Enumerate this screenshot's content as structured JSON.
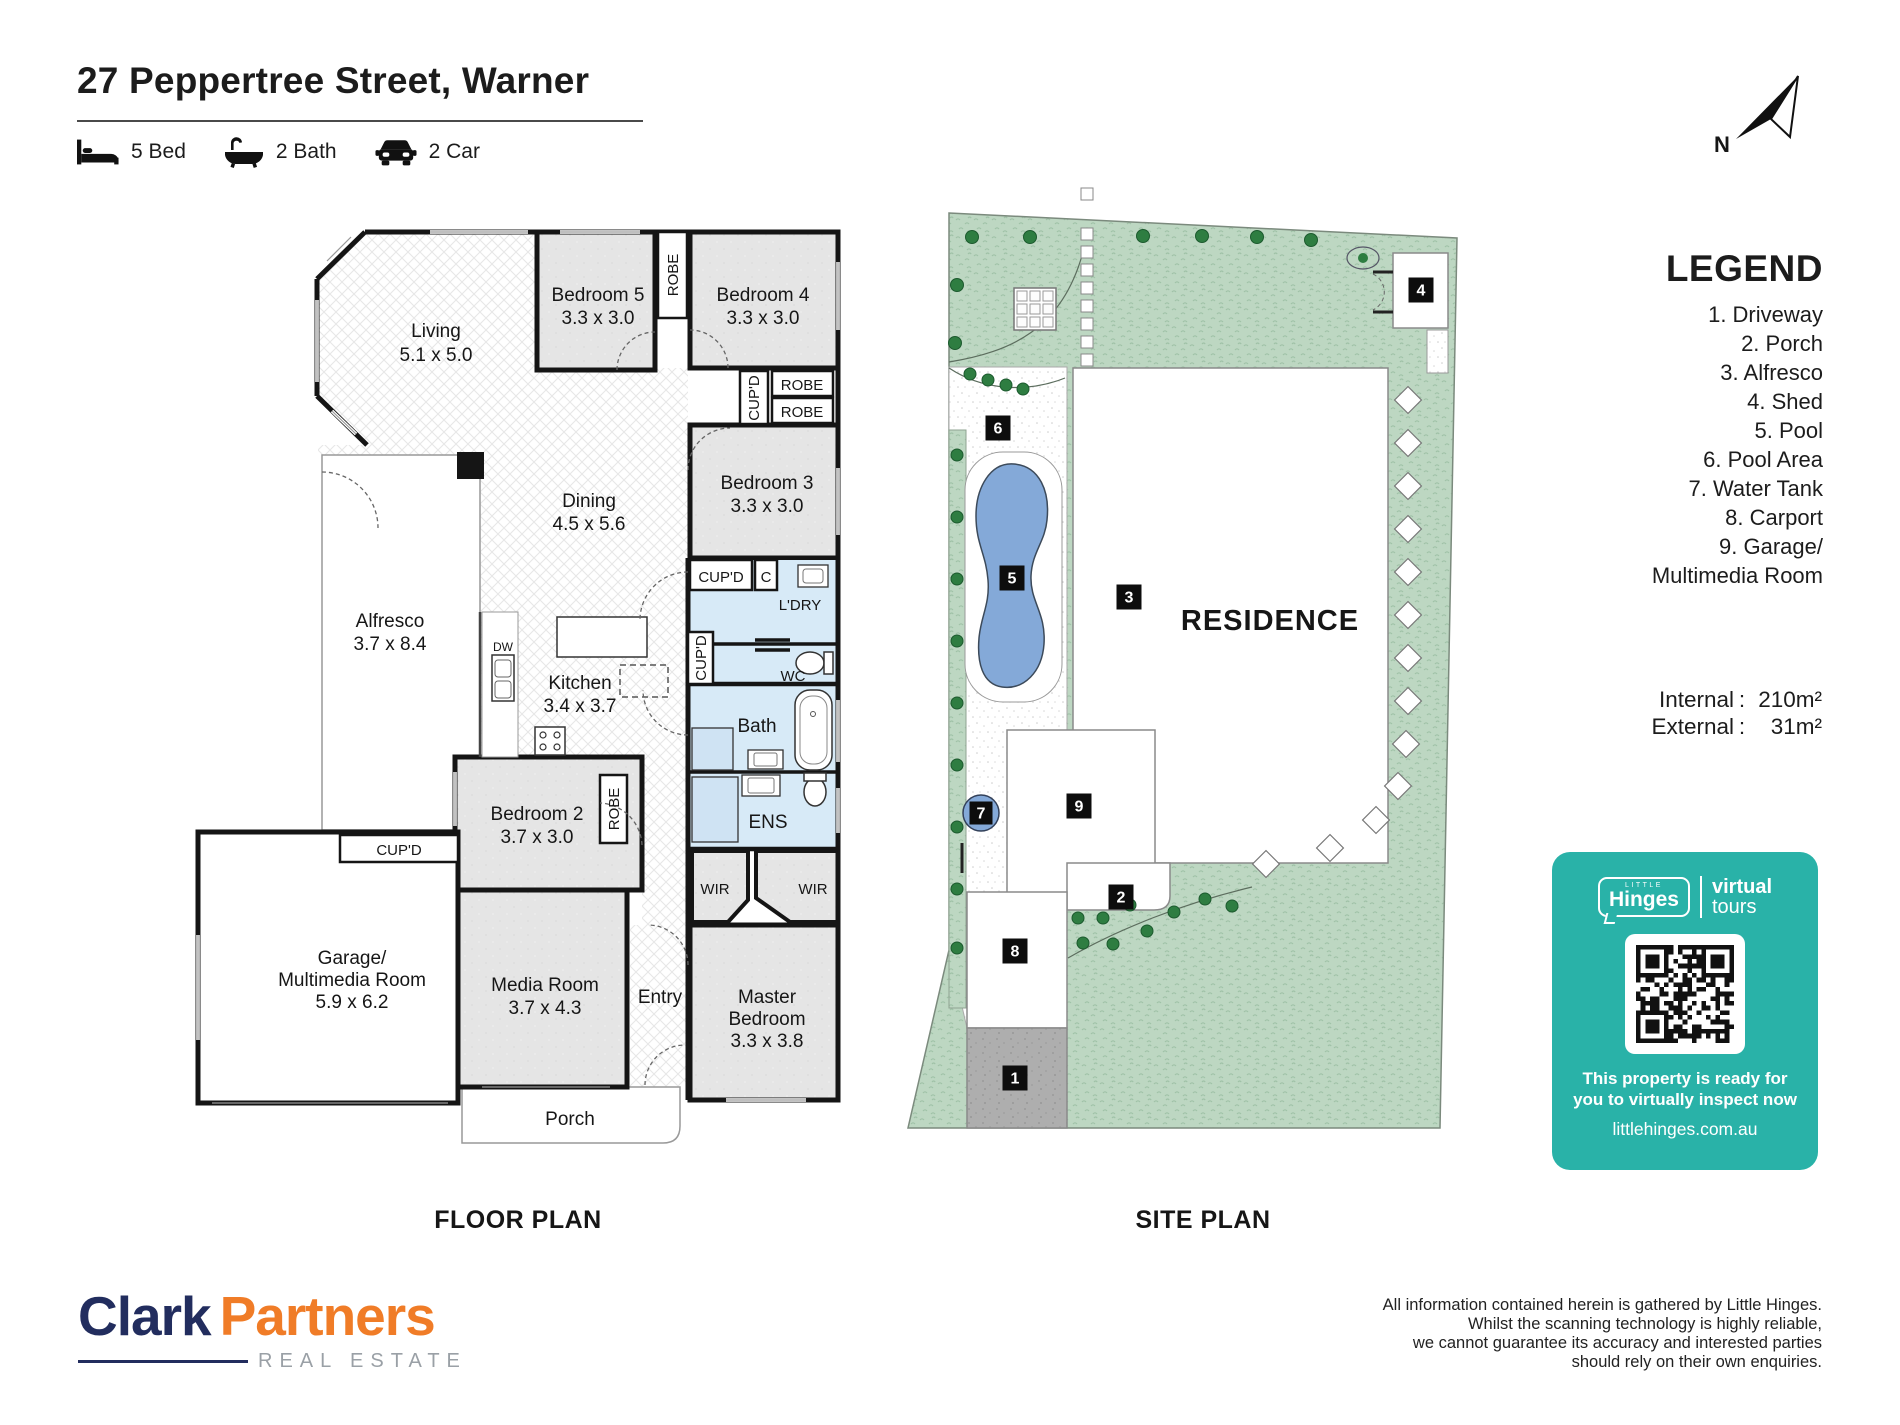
{
  "header": {
    "address": "27 Peppertree Street, Warner",
    "stats": [
      {
        "icon": "bed-icon",
        "label": "5 Bed"
      },
      {
        "icon": "bath-icon",
        "label": "2 Bath"
      },
      {
        "icon": "car-icon",
        "label": "2 Car"
      }
    ]
  },
  "north": {
    "label": "N"
  },
  "floor_plan": {
    "title": "FLOOR PLAN",
    "rooms": {
      "living": {
        "name": "Living",
        "dims": "5.1 x 5.0"
      },
      "bedroom5": {
        "name": "Bedroom 5",
        "dims": "3.3 x 3.0"
      },
      "bedroom4": {
        "name": "Bedroom 4",
        "dims": "3.3 x 3.0"
      },
      "bedroom3": {
        "name": "Bedroom 3",
        "dims": "3.3 x 3.0"
      },
      "bedroom2": {
        "name": "Bedroom 2",
        "dims": "3.7 x 3.0"
      },
      "master": {
        "name_line1": "Master",
        "name_line2": "Bedroom",
        "dims": "3.3 x 3.8"
      },
      "dining": {
        "name": "Dining",
        "dims": "4.5 x 5.6"
      },
      "kitchen": {
        "name": "Kitchen",
        "dims": "3.4 x 3.7"
      },
      "alfresco": {
        "name": "Alfresco",
        "dims": "3.7 x 8.4"
      },
      "garage": {
        "name_line1": "Garage/",
        "name_line2": "Multimedia Room",
        "dims": "5.9 x 6.2"
      },
      "media": {
        "name": "Media Room",
        "dims": "3.7 x 4.3"
      }
    },
    "labels": {
      "robe": "ROBE",
      "cupd": "CUP'D",
      "c": "C",
      "ldry": "L'DRY",
      "wc": "WC",
      "bath": "Bath",
      "ens": "ENS",
      "wir": "WIR",
      "dw": "DW",
      "entry": "Entry",
      "porch": "Porch"
    }
  },
  "site_plan": {
    "title": "SITE PLAN",
    "residence": "RESIDENCE",
    "markers": [
      "1",
      "2",
      "3",
      "4",
      "5",
      "6",
      "7",
      "8",
      "9"
    ]
  },
  "legend": {
    "title": "LEGEND",
    "lines": [
      "1. Driveway",
      "2. Porch",
      "3. Alfresco",
      "4. Shed",
      "5. Pool",
      "6. Pool Area",
      "7. Water Tank",
      "8. Carport",
      "9. Garage/",
      "Multimedia Room"
    ]
  },
  "areas": {
    "internal_label": "Internal",
    "external_label": "External",
    "colon": ":",
    "internal_value": "210m²",
    "external_value": "31m²"
  },
  "virtual_tours": {
    "brand_top": "LITTLE",
    "brand": "Hinges",
    "word1": "virtual",
    "word2": "tours",
    "message1": "This property is ready for",
    "message2": "you to virtually inspect now",
    "website": "littlehinges.com.au",
    "accent_color": "#29b2a8"
  },
  "agency": {
    "name_primary": "Clark",
    "name_secondary": "Partners",
    "subtitle": "REAL ESTATE",
    "primary_color": "#222d5e",
    "secondary_color": "#f07c27"
  },
  "disclaimer": {
    "lines": [
      "All information contained herein is gathered by Little Hinges.",
      "Whilst the scanning technology is highly reliable,",
      "we cannot guarantee its accuracy and interested parties",
      "should rely on their own enquiries."
    ]
  }
}
